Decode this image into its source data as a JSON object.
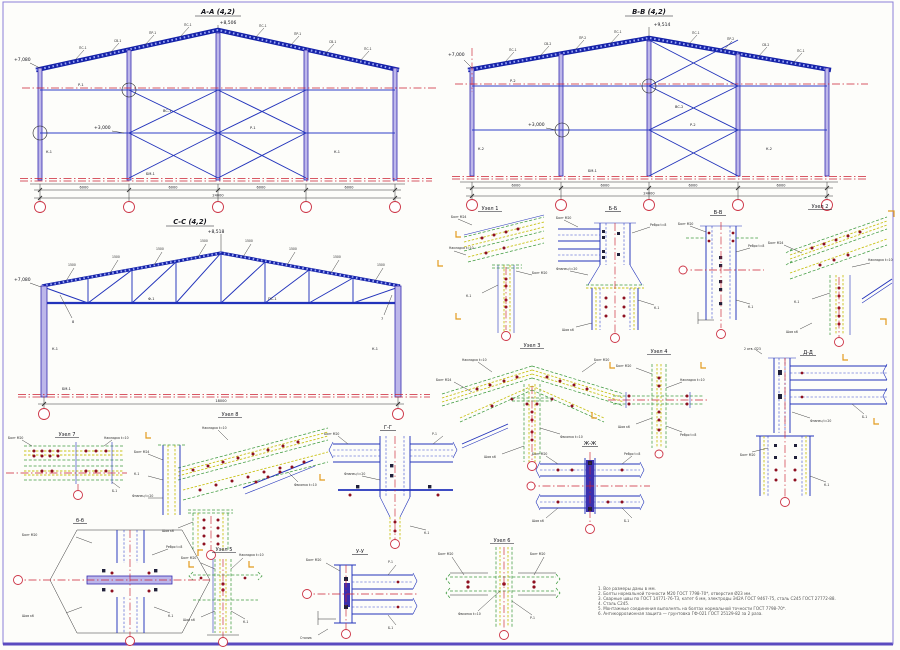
{
  "sheet": {
    "border_color": "#8a80d8",
    "bg": "#fdfdfa"
  },
  "sections": {
    "aa": {
      "title": "А-А (4,2)",
      "apex_elev": "+8,506",
      "eave_elev": "+7,080",
      "mid_elev": "+3,000",
      "bay_dim": "6000",
      "total_dim": "24000",
      "girt_label": "Р-1",
      "col_label": "К-1",
      "brace_label": "ВС-1",
      "base_label": "БМ-1",
      "purlin": "ПС-1",
      "rafter": "ПР-1",
      "tie": "СВ-1"
    },
    "bb": {
      "title": "В-В (4,2)",
      "apex_elev": "+9,514",
      "eave_elev": "+7,000",
      "mid_elev": "+3,000",
      "bay_dim": "6000",
      "total_dim": "24000",
      "girt_label": "Р-2",
      "col_label": "К-2",
      "brace_label": "ВС-2",
      "base_label": "БМ-1",
      "purlin": "ПС-1",
      "rafter": "ПР-2",
      "tie": "СВ-2"
    },
    "cc": {
      "title": "С-С (4,2)",
      "apex_elev": "+8,518",
      "eave_elev": "+7,080",
      "panel_dim": "1500",
      "total_dim": "18000",
      "truss_label": "Ф-1",
      "col_label": "К-1",
      "base_label": "БМ-1",
      "purlin": "ПС-1",
      "pos_left": "8",
      "pos_right": "7"
    }
  },
  "details": {
    "uz1": {
      "title": "Узел 1"
    },
    "bb": {
      "title": "Б-Б"
    },
    "vv": {
      "title": "В-В"
    },
    "uz2": {
      "title": "Узел 2"
    },
    "uz3": {
      "title": "Узел 3"
    },
    "uz4": {
      "title": "Узел 4"
    },
    "dd": {
      "title": "Д-Д"
    },
    "zh": {
      "title": "Ж-Ж"
    },
    "gg": {
      "title": "Г-Г"
    },
    "uz7": {
      "title": "Узел 7"
    },
    "uz8": {
      "title": "Узел 8"
    },
    "bb2": {
      "title": "б-б"
    },
    "uz5": {
      "title": "Узел 5"
    },
    "uu": {
      "title": "У-У"
    },
    "uz6": {
      "title": "Узел 6"
    }
  },
  "callouts": {
    "bolt": "Болт М20",
    "bolt24": "Болт М24",
    "plate": "Накладка t=10",
    "flange": "Фланец t=20",
    "rib": "Ребро t=8",
    "gusset": "Фасонка t=10",
    "col": "К-1",
    "beam": "Б-1",
    "girt": "Р-1",
    "weld": "Шов к6",
    "holes": "2 отв. Ø23",
    "table": "Столик"
  },
  "section_marks": {
    "b": "б",
    "g": "г",
    "zh": "ж",
    "i": "и",
    "a": "а",
    "u": "у",
    "k": "к"
  },
  "notes": {
    "lines": [
      "1. Все размеры даны в мм.",
      "2. Болты нормальной точности М20 ГОСТ 7798-70*, отверстия Ø23 мм.",
      "3. Сварные швы по ГОСТ 14771-76-Т3, катет 6 мм, электроды Э42А ГОСТ 9467-75, сталь С245 ГОСТ 27772-88.",
      "4. Сталь С245.",
      "5. Монтажные соединения выполнять на болтах нормальной точности ГОСТ 7798-70*.",
      "6. Антикоррозионная защита — грунтовка ГФ-021 ГОСТ 25129-82 за 2 раза."
    ]
  }
}
